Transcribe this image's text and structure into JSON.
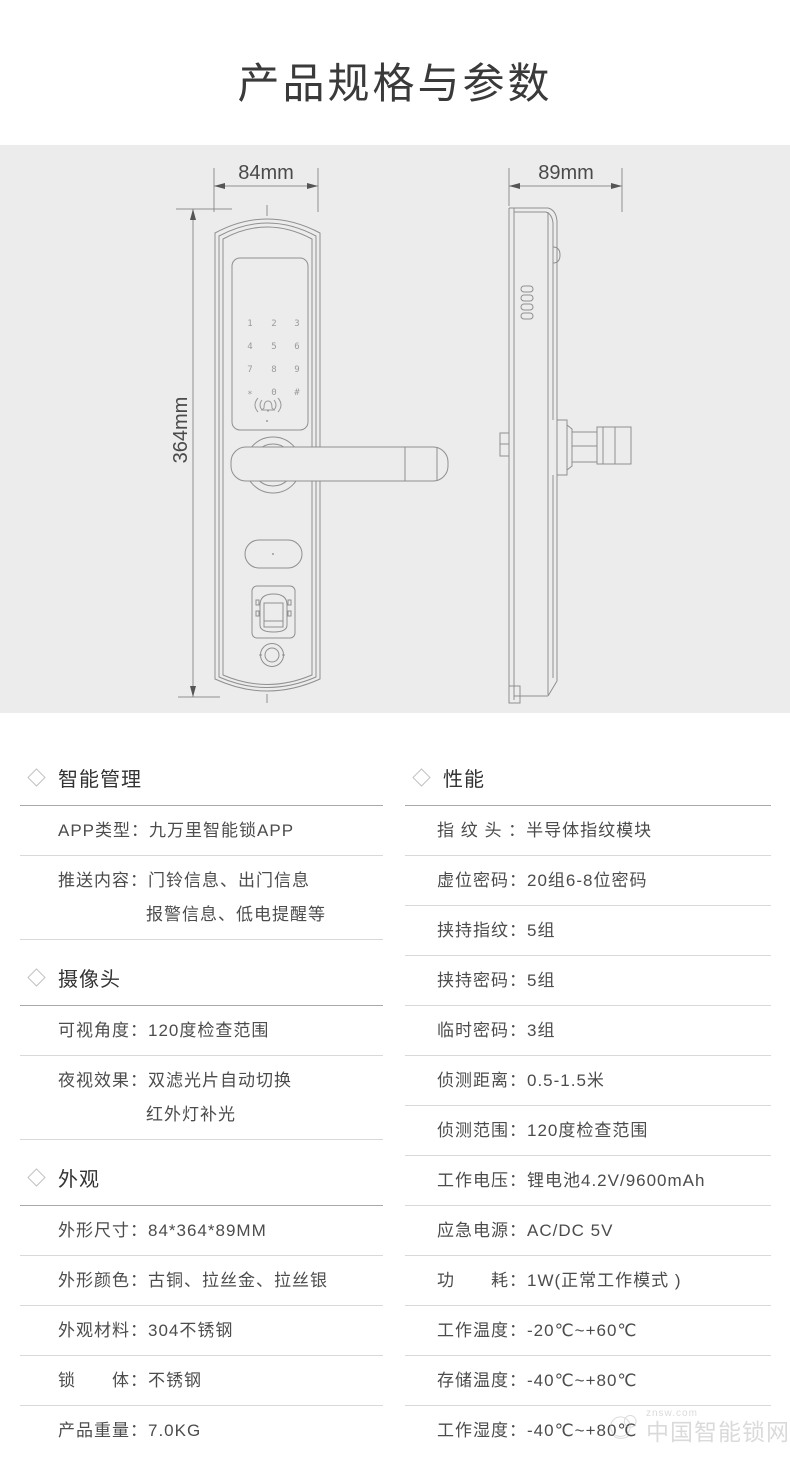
{
  "title": "产品规格与参数",
  "diagram": {
    "front_width": "84mm",
    "side_depth": "89mm",
    "height": "364mm",
    "keypad": [
      "1",
      "2",
      "3",
      "4",
      "5",
      "6",
      "7",
      "8",
      "9",
      "*",
      "0",
      "#"
    ]
  },
  "left": [
    {
      "title": "智能管理",
      "rows": [
        {
          "text": "APP类型：九万里智能锁APP"
        },
        {
          "text": "推送内容：门铃信息、出门信息",
          "text2": "报警信息、低电提醒等"
        }
      ]
    },
    {
      "title": "摄像头",
      "rows": [
        {
          "text": "可视角度：120度检查范围"
        },
        {
          "text": "夜视效果：双滤光片自动切换",
          "text2": "红外灯补光"
        }
      ]
    },
    {
      "title": "外观",
      "rows": [
        {
          "text": "外形尺寸：84*364*89MM"
        },
        {
          "text": "外形颜色：古铜、拉丝金、拉丝银"
        },
        {
          "text": "外观材料：304不锈钢"
        },
        {
          "text": "锁　　体：不锈钢"
        },
        {
          "text": "产品重量：7.0KG"
        }
      ]
    }
  ],
  "right": [
    {
      "title": "性能",
      "rows": [
        {
          "text": "指 纹 头 ：半导体指纹模块"
        },
        {
          "text": "虚位密码：20组6-8位密码"
        },
        {
          "text": "挟持指纹：5组"
        },
        {
          "text": "挟持密码：5组"
        },
        {
          "text": "临时密码：3组"
        },
        {
          "text": "侦测距离：0.5-1.5米"
        },
        {
          "text": "侦测范围：120度检查范围"
        },
        {
          "text": "工作电压：锂电池4.2V/9600mAh"
        },
        {
          "text": "应急电源：AC/DC 5V"
        },
        {
          "text": "功　　耗：1W(正常工作模式 )"
        },
        {
          "text": "工作温度：-20℃~+60℃"
        },
        {
          "text": "存储温度：-40℃~+80℃"
        },
        {
          "text": "工作湿度：-40℃~+80℃"
        }
      ]
    }
  ],
  "watermark": {
    "site": "znsw.com",
    "name": "中国智能锁网"
  }
}
